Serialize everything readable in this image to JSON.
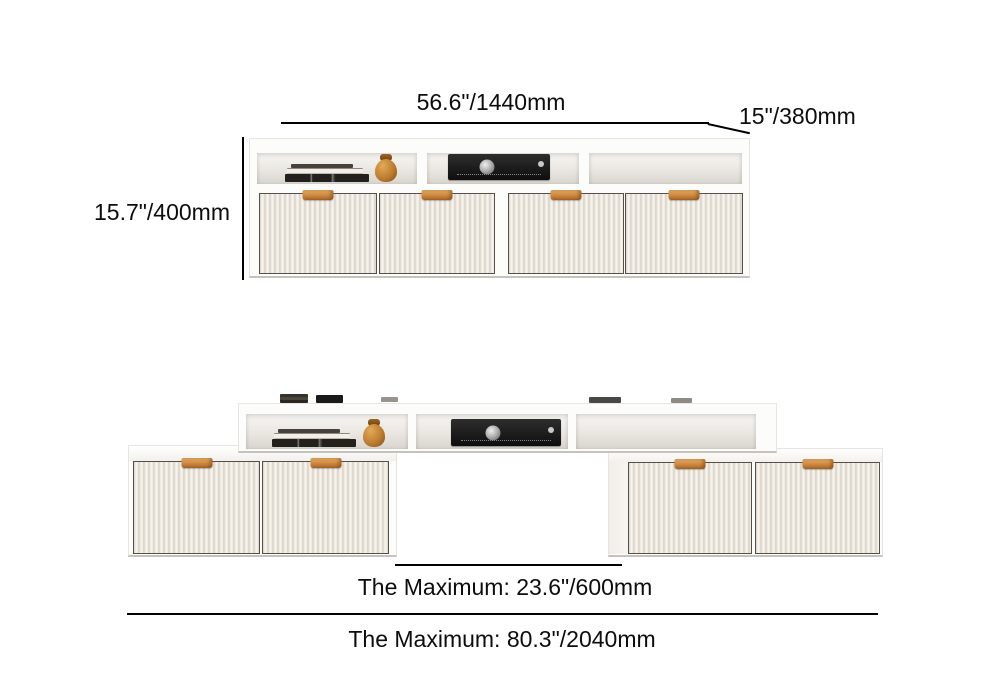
{
  "page": {
    "background": "#ffffff",
    "text_color": "#0d0d0d",
    "line_color": "#000000",
    "handle_accent_color": "#cd8740",
    "cabinet_color": "#fcfcfa"
  },
  "upper_unit": {
    "width_label": "56.6\"/1440mm",
    "depth_label": "15\"/380mm",
    "height_label": "15.7\"/400mm",
    "door_count": 4,
    "open_compartments": 3,
    "decor": [
      "books",
      "wooden-jar",
      "av-receiver"
    ]
  },
  "lower_unit": {
    "extension_label": "The Maximum: 23.6\"/600mm",
    "overall_width_label": "The Maximum: 80.3\"/2040mm",
    "door_count": 4,
    "open_compartments": 3,
    "decor": [
      "books",
      "wooden-jar",
      "av-receiver",
      "tabletop-items"
    ]
  }
}
